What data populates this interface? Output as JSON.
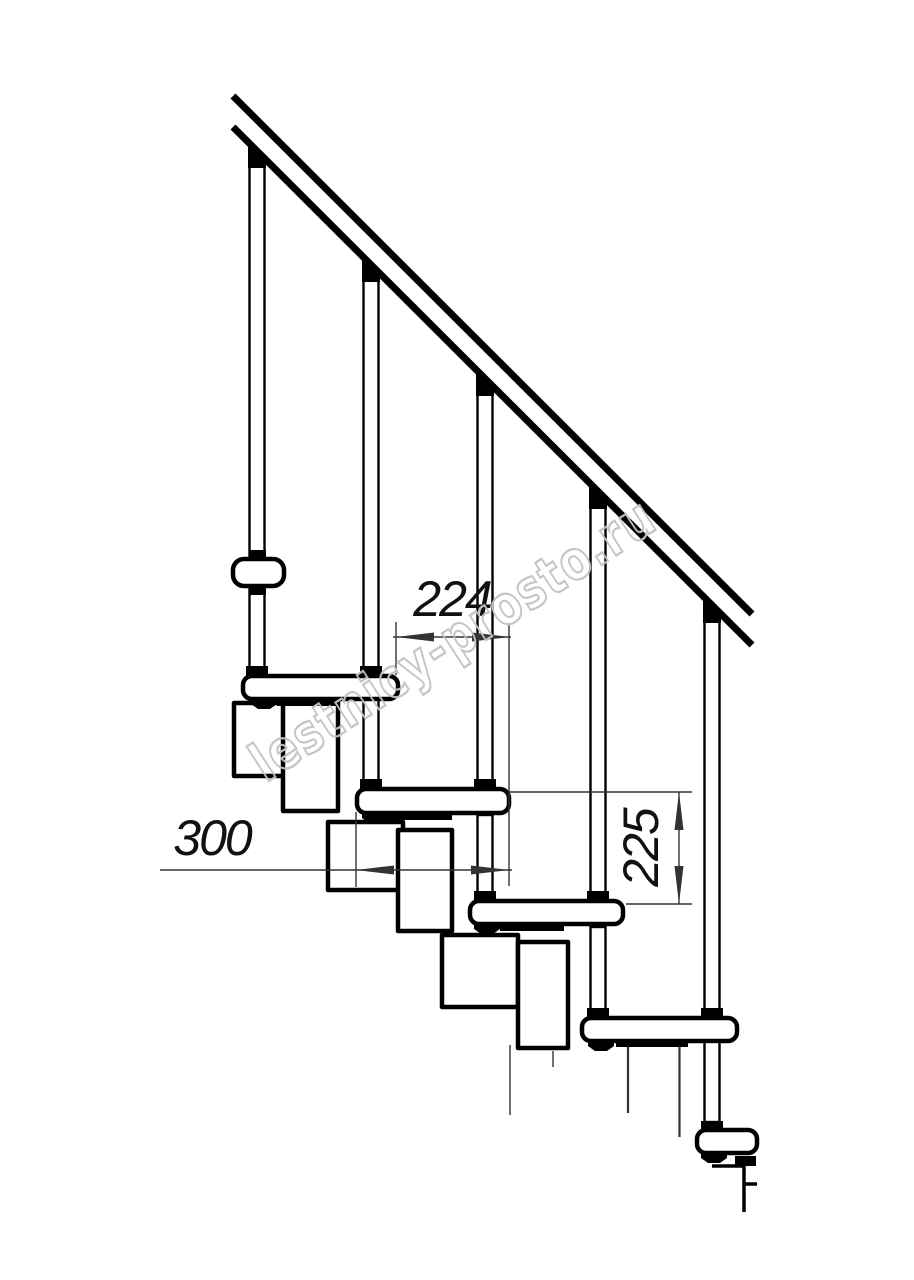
{
  "colors": {
    "background": "#ffffff",
    "outline": "#000000",
    "dimension": "#333333",
    "watermark": "#c3c3c3"
  },
  "dimensions": {
    "step_run": "224",
    "tread_depth": "300",
    "step_rise": "225"
  },
  "watermark": {
    "text": "lestnicy-prosto.ru"
  }
}
